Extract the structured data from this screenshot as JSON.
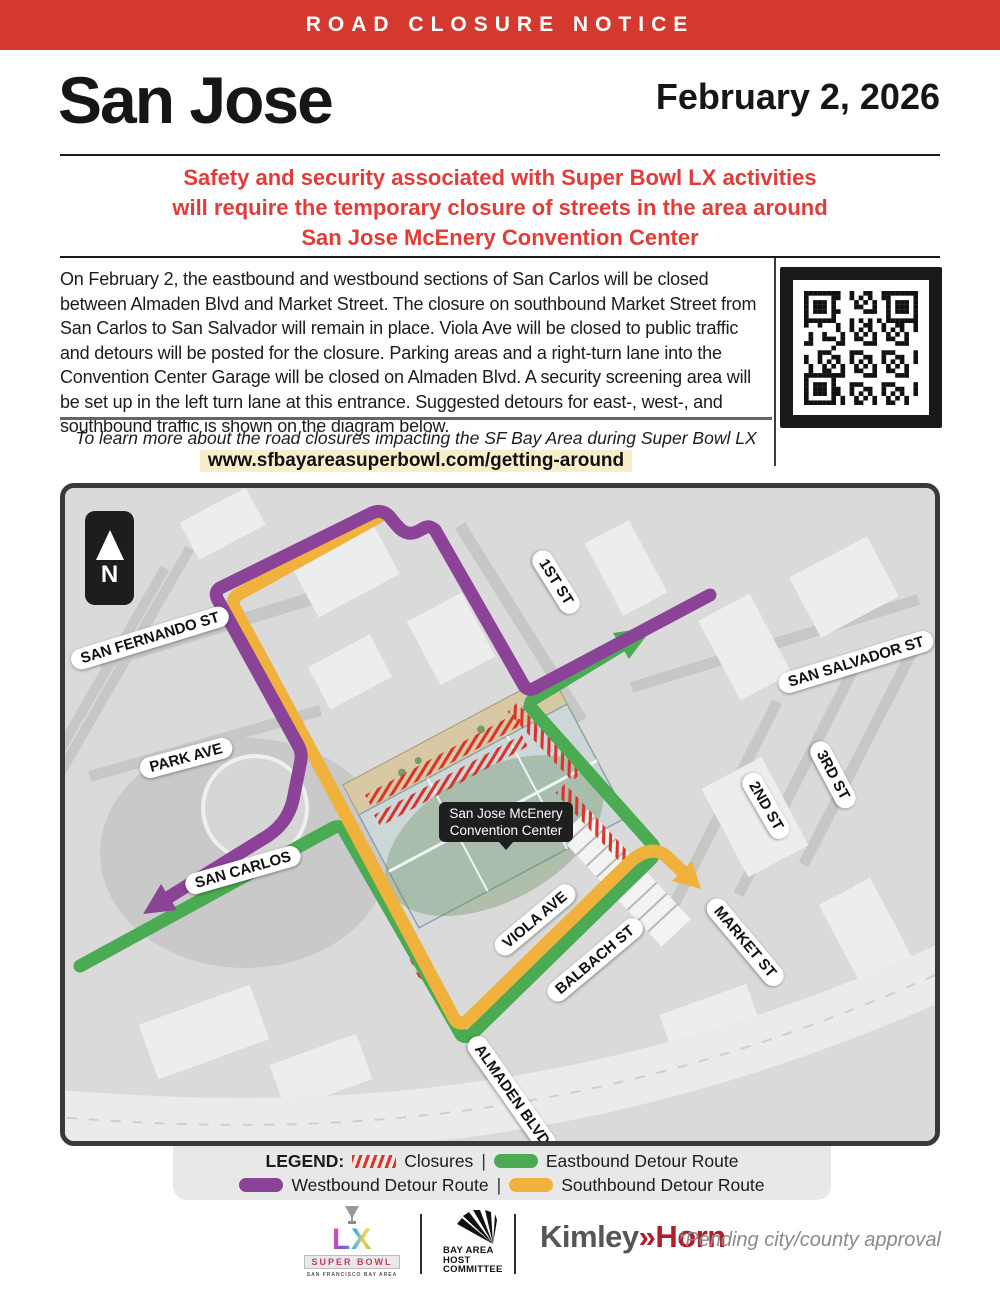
{
  "banner": {
    "text": "ROAD CLOSURE NOTICE"
  },
  "header": {
    "city": "San Jose",
    "date": "February 2, 2026"
  },
  "subtitle": {
    "lines": [
      "Safety and security associated with Super Bowl LX activities",
      "will require the temporary closure of streets in the area around",
      "San Jose McEnery Convention Center"
    ]
  },
  "body": {
    "paragraph": "On February 2, the eastbound and westbound sections of San Carlos will be closed between Almaden Blvd and Market Street. The closure on southbound Market Street from San Carlos to San Salvador will remain in place. Viola Ave will be closed to public traffic and detours will be posted for the closure. Parking areas and a right-turn lane into the Convention Center Garage will be closed on Almaden Blvd. A security screening area will be set up in the left turn lane at this entrance. Suggested detours for east-, west-, and southbound traffic is shown on the diagram below."
  },
  "learn_more": {
    "text": "To learn more about the road closures impacting the SF Bay Area during Super Bowl LX week, please visit:",
    "url": "www.sfbayareasuperbowl.com/getting-around"
  },
  "map": {
    "north_label": "N",
    "center_label": {
      "line1": "San Jose McEnery",
      "line2": "Convention Center"
    },
    "street_labels": [
      "SAN FERNANDO ST",
      "PARK AVE",
      "SAN CARLOS",
      "1ST ST",
      "SAN SALVADOR ST",
      "2ND ST",
      "3RD ST",
      "VIOLA AVE",
      "BALBACH ST",
      "MARKET ST",
      "ALMADEN BLVD"
    ]
  },
  "legend": {
    "title": "LEGEND:",
    "closures": "Closures",
    "eastbound": "Eastbound Detour Route",
    "westbound": "Westbound Detour Route",
    "southbound": "Southbound Detour Route",
    "separator": "|"
  },
  "footer": {
    "superbowl": {
      "lx": "LX",
      "word": "SUPER BOWL",
      "tagline": "SAN FRANCISCO BAY AREA"
    },
    "host_committee": {
      "line1": "BAY AREA",
      "line2": "HOST",
      "line3": "COMMITTEE"
    },
    "kimley": {
      "part1": "Kimley",
      "arrow": "»",
      "part2": "Horn"
    },
    "approval": "*Pending city/county approval"
  },
  "colors": {
    "banner_red": "#d4392f",
    "subtitle_red": "#e23c38",
    "closure_red": "#d8342c",
    "eastbound_green": "#4aab53",
    "westbound_purple": "#8b4398",
    "southbound_yellow": "#f0b23c",
    "url_highlight": "#f8eecb",
    "kimley_red": "#af1e2d"
  }
}
